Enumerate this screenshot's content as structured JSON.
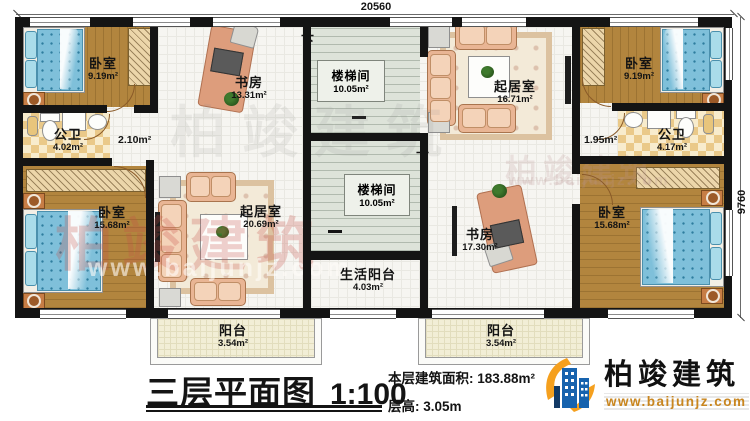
{
  "dimensions": {
    "top": "20560",
    "right": "9760"
  },
  "stairs": {
    "down": "下"
  },
  "rooms": {
    "bedroom_tl": {
      "name": "卧室",
      "area": "9.19m²"
    },
    "study_upper": {
      "name": "书房",
      "area": "13.31m²"
    },
    "stair_upper": {
      "name": "楼梯间",
      "area": "10.05m²"
    },
    "living_upper": {
      "name": "起居室",
      "area": "16.71m²"
    },
    "bedroom_tr": {
      "name": "卧室",
      "area": "9.19m²"
    },
    "bath_left": {
      "name": "公卫",
      "area": "4.02m²"
    },
    "hall_left": {
      "area": "2.10m²"
    },
    "hall_right": {
      "area": "1.95m²"
    },
    "bath_right": {
      "name": "公卫",
      "area": "4.17m²"
    },
    "bedroom_bl": {
      "name": "卧室",
      "area": "15.68m²"
    },
    "living_lower": {
      "name": "起居室",
      "area": "20.69m²"
    },
    "stair_lower": {
      "name": "楼梯间",
      "area": "10.05m²"
    },
    "study_lower": {
      "name": "书房",
      "area": "17.30m²"
    },
    "bedroom_br": {
      "name": "卧室",
      "area": "15.68m²"
    },
    "service_balcony": {
      "name": "生活阳台",
      "area": "4.03m²"
    },
    "balcony_left": {
      "name": "阳台",
      "area": "3.54m²"
    },
    "balcony_right": {
      "name": "阳台",
      "area": "3.54m²"
    }
  },
  "title": {
    "text": "三层平面图",
    "scale": "1:100"
  },
  "info": {
    "area_label": "本层建筑面积:",
    "area_value": "183.88m²",
    "height_label": "层高:",
    "height_value": "3.05m"
  },
  "brand": {
    "name": "柏竣建筑",
    "website": "www.baijunjz.com"
  },
  "colors": {
    "wall": "#141414",
    "wood": "#b2853e",
    "bed_blue": "#7fc0da",
    "accent_orange": "#f5a01e",
    "accent_blue": "#1763ae"
  }
}
